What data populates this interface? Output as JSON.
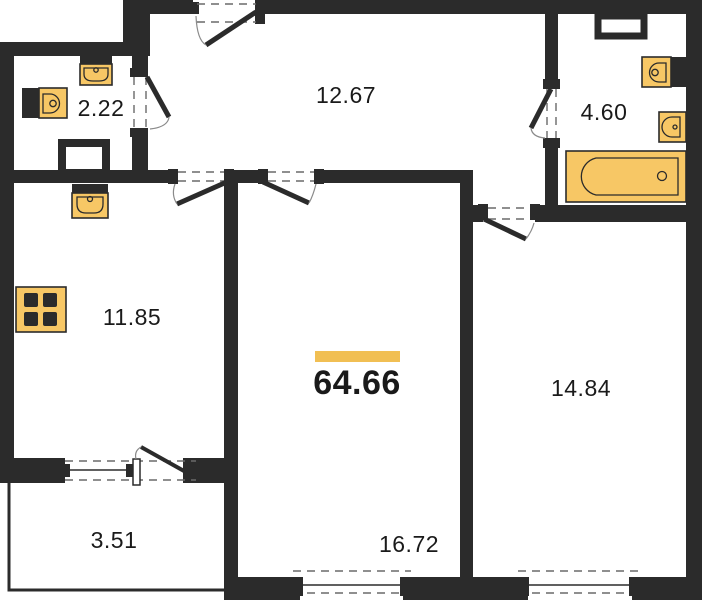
{
  "plan": {
    "title": "apartment floor plan",
    "total_area": "64.66",
    "rooms": [
      {
        "id": "bathroom-small",
        "area": "2.22"
      },
      {
        "id": "hallway",
        "area": "12.67"
      },
      {
        "id": "bathroom",
        "area": "4.60"
      },
      {
        "id": "kitchen",
        "area": "11.85"
      },
      {
        "id": "living-room",
        "area": "16.72"
      },
      {
        "id": "bedroom",
        "area": "14.84"
      },
      {
        "id": "balcony",
        "area": "3.51"
      }
    ],
    "fixtures": [
      "sink-icon",
      "toilet-icon",
      "bathtub-icon",
      "stove-icon"
    ],
    "colors": {
      "wall": "#2b2b2b",
      "fixture_fill": "#f7c765",
      "fixture_outline": "#2b2b2b",
      "accent_bar": "#f1bf53",
      "text": "#1a1a1a",
      "background": "#ffffff",
      "dash": "#6a6a6a",
      "arc": "#8a8a8a"
    }
  }
}
